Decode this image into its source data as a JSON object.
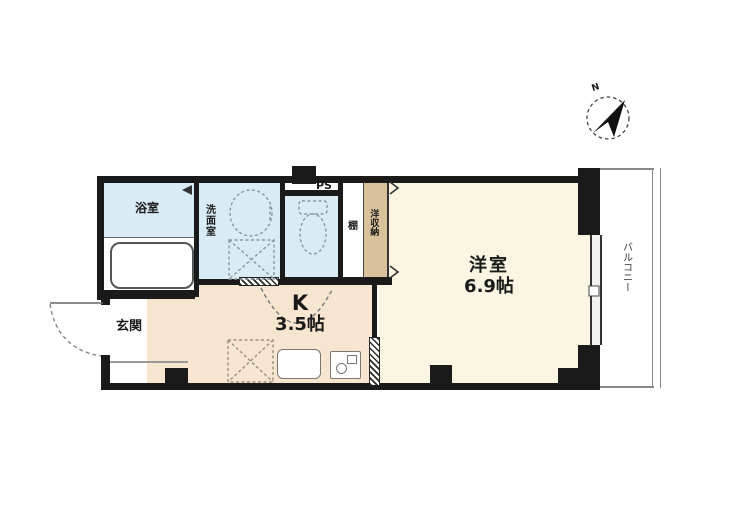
{
  "plan_title": "1K apartment floor plan",
  "colors": {
    "wall": "#1a1a1a",
    "wet_area_floor": "#d9ebf4",
    "kitchen_floor": "#f8e5d0",
    "living_floor": "#fbf6e2",
    "closet_fill": "#d8c19b",
    "outline": "#777777"
  },
  "rooms": {
    "bathroom": {
      "label": "浴室"
    },
    "washroom": {
      "label": "洗面室"
    },
    "pipe_space": {
      "label": "PS"
    },
    "shelf": {
      "label": "棚"
    },
    "closet": {
      "label": "洋収納"
    },
    "kitchen": {
      "label": "K",
      "size": "3.5帖"
    },
    "entry": {
      "label": "玄関"
    },
    "living_room": {
      "label": "洋室",
      "size": "6.9帖"
    },
    "balcony": {
      "label": "バルコニー"
    }
  },
  "fixtures": [
    "bathtub",
    "wash-basin",
    "washing-machine-space",
    "toilet",
    "refrigerator-space",
    "kitchen-sink",
    "gas-stove",
    "entry-door",
    "toilet-door",
    "sliding-doors",
    "balcony-window"
  ],
  "compass": {
    "label": "N",
    "direction": "north-east"
  }
}
